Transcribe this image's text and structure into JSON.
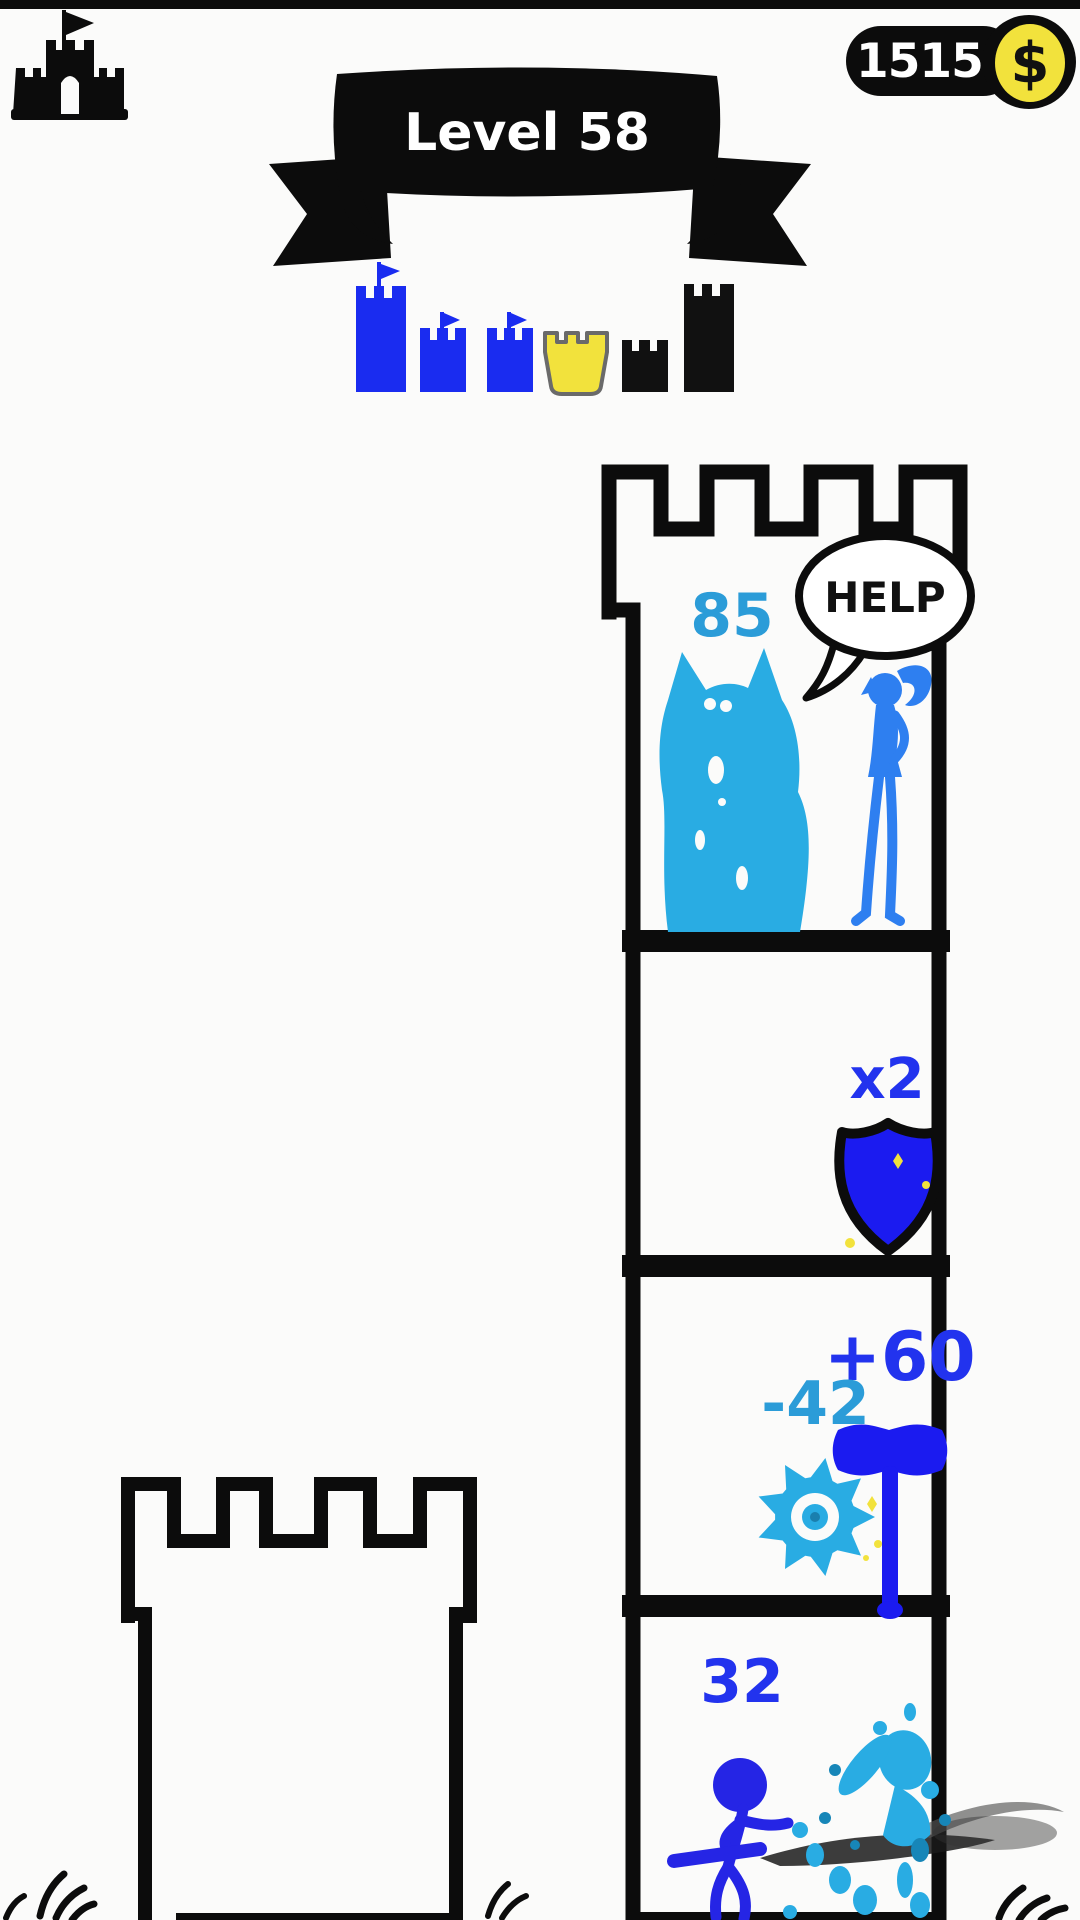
{
  "hud": {
    "coin_count": "15150",
    "coin_symbol": "$",
    "level_banner": "Level 58"
  },
  "speech": {
    "help": "HELP"
  },
  "tower": {
    "floor_top": {
      "count": "85"
    },
    "floor_shield": {
      "multiplier": "x2"
    },
    "floor_weapons": {
      "bonus": "+60",
      "penalty": "-42"
    },
    "floor_battle": {
      "count": "32"
    }
  },
  "progress": {
    "castles": [
      {
        "id": "castle-1",
        "size": "tall",
        "status": "completed",
        "flag": true,
        "color": "#1a2cf0"
      },
      {
        "id": "castle-2",
        "size": "small",
        "status": "completed",
        "flag": true,
        "color": "#1a2cf0"
      },
      {
        "id": "castle-3",
        "size": "small",
        "status": "completed",
        "flag": true,
        "color": "#1a2cf0"
      },
      {
        "id": "castle-4",
        "size": "small",
        "status": "current",
        "flag": false,
        "color": "#f2e23c"
      },
      {
        "id": "castle-5",
        "size": "small",
        "status": "locked",
        "flag": false,
        "color": "#111111"
      },
      {
        "id": "castle-6",
        "size": "tall",
        "status": "locked",
        "flag": false,
        "color": "#111111"
      }
    ]
  },
  "colors": {
    "black": "#0c0c0c",
    "white": "#ffffff",
    "yellow": "#f2e23c",
    "castle_blue": "#1a2cf0",
    "royal_blue": "#1b1bf0",
    "hero_blue": "#2525e5",
    "princess_blue": "#2e7ff0",
    "cyan": "#29ace3",
    "cyan_dark": "#1786b8",
    "badge_blue": "#2233ee",
    "badge_cyan": "#2b9cd8",
    "smoke_gray": "#555555"
  }
}
